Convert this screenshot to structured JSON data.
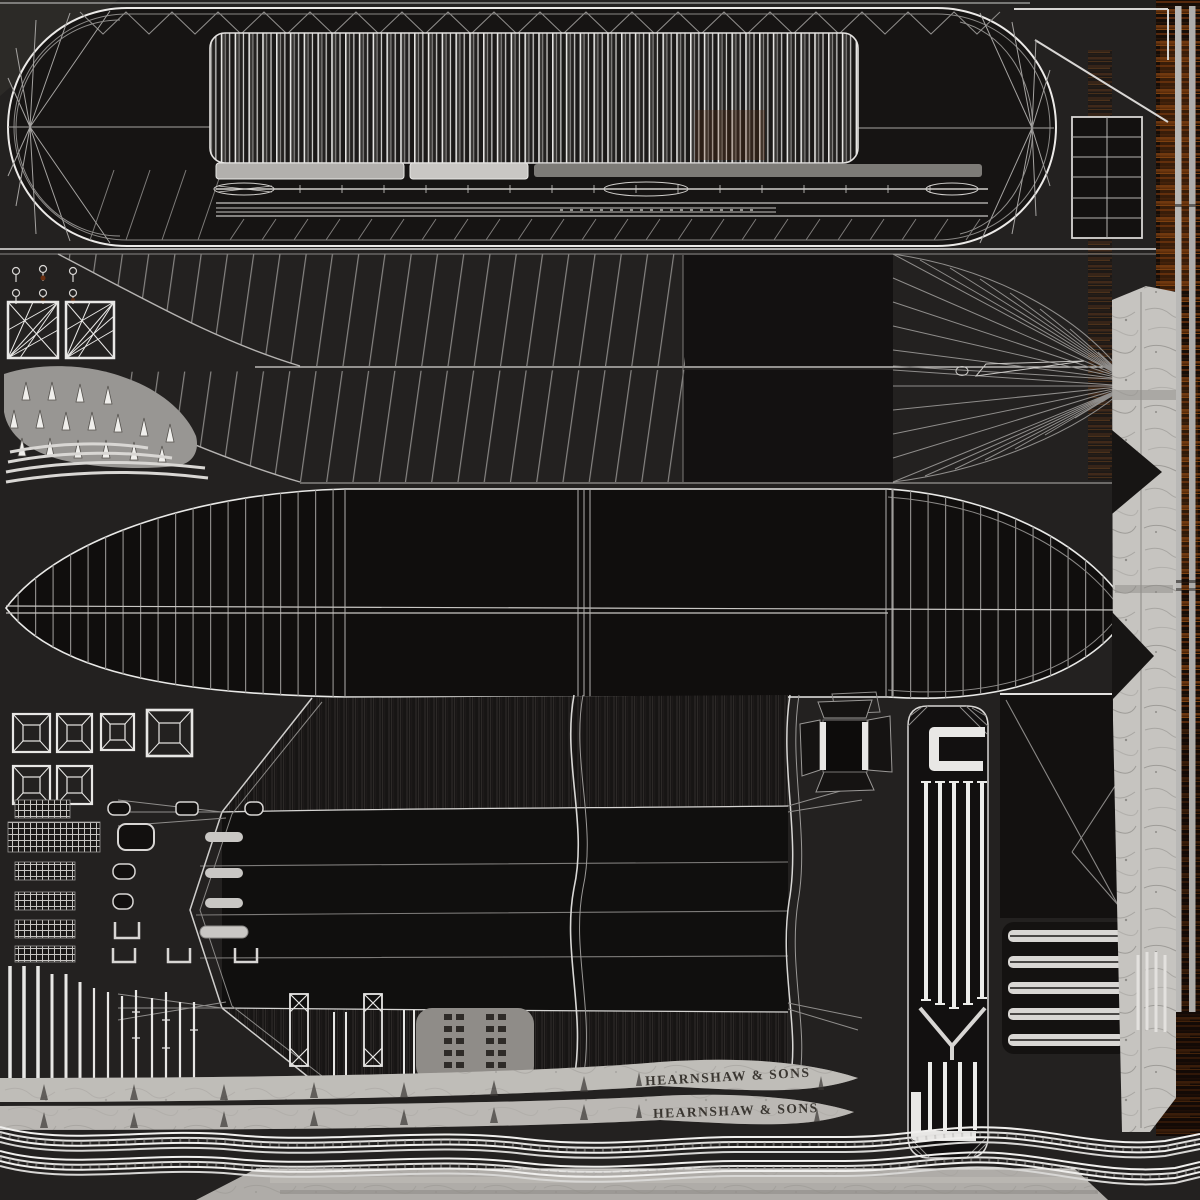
{
  "nameplate": {
    "top": "HEARNSHAW & SONS",
    "bottom": "HEARNSHAW & SONS"
  },
  "colors": {
    "background": "#232120",
    "wireframe": "#e8e7e5",
    "wireframe_dim": "#8a8886",
    "panel_dark": "#121010",
    "plank_light": "#d8d6d4",
    "marble_light": "#c6c4c0",
    "deck_bar": "#b2b0ad",
    "rust_orange": "#7a3c0e",
    "wood_brown": "#56280c",
    "mast_gray": "#b9b8b6",
    "nameplate_text": "#3a3631",
    "bottom_band": "#a5a29d"
  },
  "atlas": {
    "deck_island": {
      "planks": 47,
      "deck_bars": 3
    },
    "hull_side_band": {
      "bow_panels": 2,
      "stern_fans": 2
    },
    "hull_plan_island": {
      "rib_spacing_px": 17,
      "vertical_seams": 3
    },
    "frustum_hatches": 6,
    "fan_squares": 2,
    "cone_spikes": 17,
    "deck_knobs": 6,
    "pins": 14,
    "grate_bars_upper": 5,
    "grate_bars_lower": 4,
    "tread_steps": 5,
    "rope_strands_per_group": 4,
    "rope_groups": 2,
    "masts": 2,
    "nameplate_bands": 2
  }
}
